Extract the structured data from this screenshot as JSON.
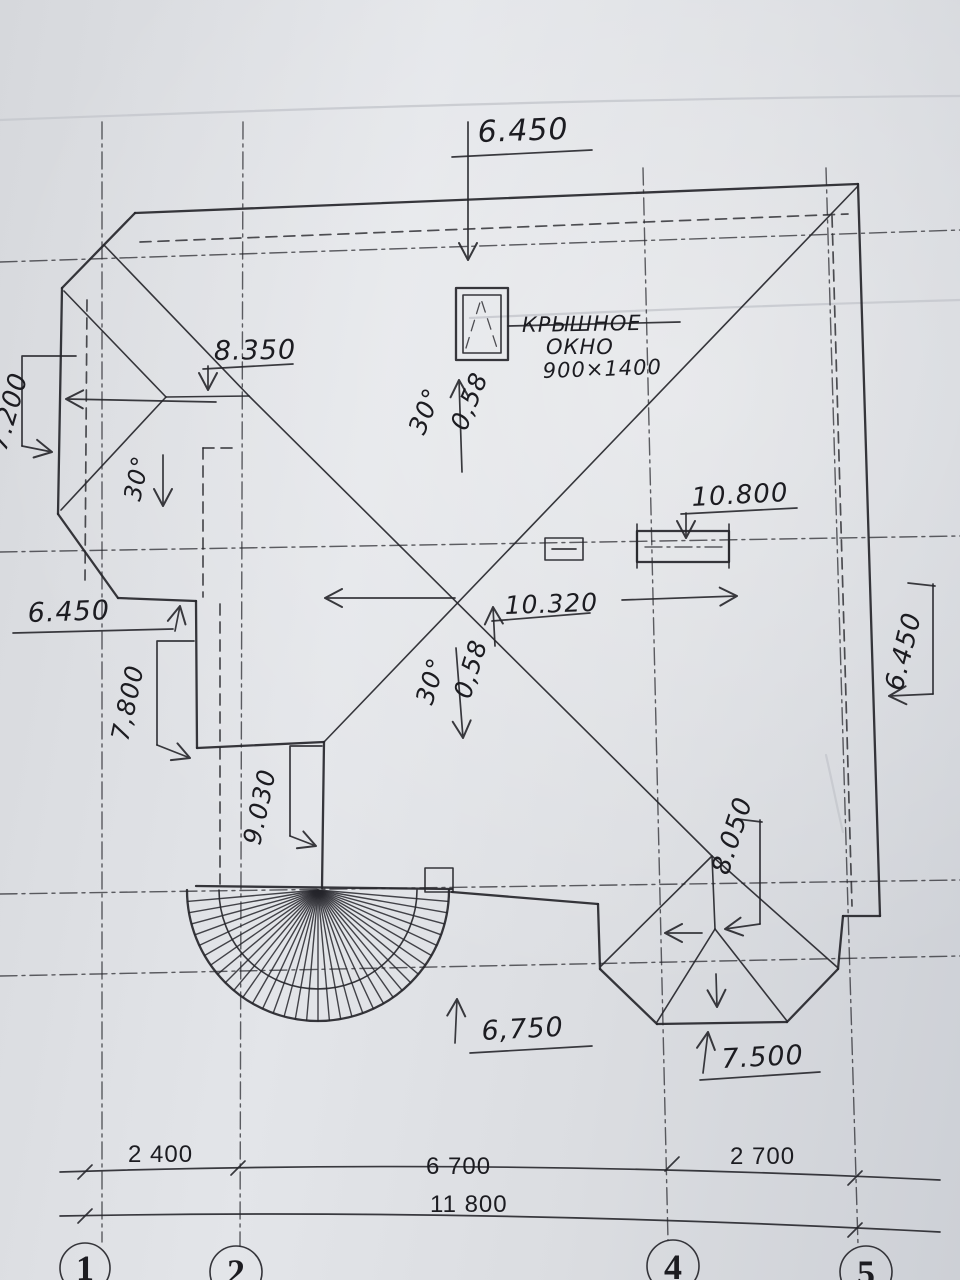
{
  "document_kind": "scanned architectural roof plan",
  "labels": {
    "top_elevation": "6.450",
    "roof_window": {
      "line1": "КРЫШНОЕ",
      "line2": "ОКНО",
      "line3": "900×1400"
    },
    "ridge_left": "8.350",
    "left_edge_height": "7.200",
    "slope_angle_left": "30°",
    "slope_angle_upper": "30°",
    "slope_ratio_upper": "0,58",
    "slope_angle_lower": "30°",
    "slope_ratio_lower": "0,58",
    "wing_eave": "6.450",
    "wing_wall": "7,800",
    "tower_ridge": "9.030",
    "center_ridge": "10.320",
    "chimney_height": "10.800",
    "right_eave": "6.450",
    "bay_wall": "8.050",
    "low_eave": "6,750",
    "bay_eave": "7.500"
  },
  "axis_dimensions": {
    "span_1_2": "2 400",
    "span_2_4": "6 700",
    "span_4_5": "2 700",
    "total": "11 800"
  },
  "grid_bubbles": [
    {
      "label": "1"
    },
    {
      "label": "2"
    },
    {
      "label": "4"
    },
    {
      "label": "5"
    }
  ],
  "colors": {
    "ink": "#26262b",
    "paper": "#dcdee2"
  }
}
